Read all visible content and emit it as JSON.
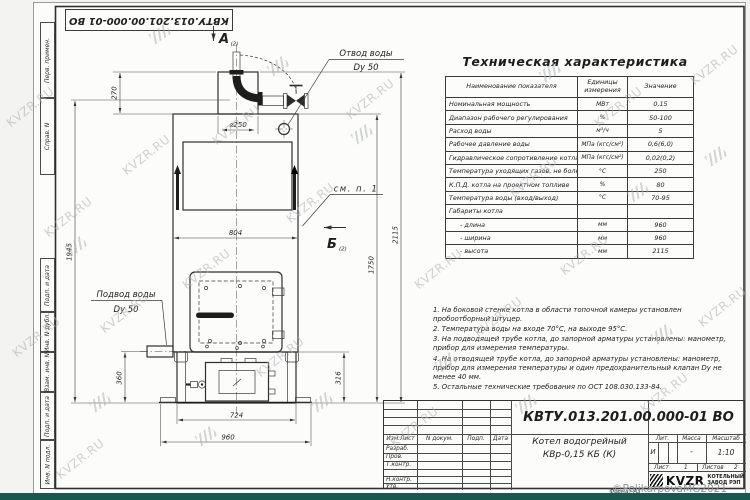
{
  "doc_number": "КВТУ.013.201.00.000-01 ВО",
  "wm": {
    "site": "KVZR.RU",
    "copyright": "©PolikarpovaMG2021"
  },
  "margin": {
    "items": [
      "Перв. примен.",
      "Справ. N",
      "Подп. и дата",
      "Инв. N дубл.",
      "Взам. инв. N",
      "Подп. и дата",
      "Инв. N подл."
    ]
  },
  "drawing": {
    "view_a": "А",
    "view_b": "Б",
    "view_ref": "(2)",
    "see_note": "см. п. 1",
    "outlet": {
      "line1": "Отвод воды",
      "line2": "Dy 50"
    },
    "inlet": {
      "line1": "Подвод воды",
      "line2": "Dy 50"
    },
    "dims": {
      "d270": "270",
      "d250": "⌀250",
      "d804": "804",
      "d1945": "1945",
      "d2115": "2115",
      "d1750": "1750",
      "d360": "360",
      "d316": "316",
      "d724": "724",
      "d960": "960"
    }
  },
  "tech": {
    "title": "Техническая характеристика",
    "headers": [
      "Наименование показателя",
      "Единицы измерения",
      "Значение"
    ],
    "rows": [
      {
        "name": "Номинальная мощность",
        "unit": "МВт",
        "value": "0,15"
      },
      {
        "name": "Диапазон рабочего регулирования",
        "unit": "%",
        "value": "50-100"
      },
      {
        "name": "Расход воды",
        "unit": "м³/ч",
        "value": "5"
      },
      {
        "name": "Рабочее давление воды",
        "unit": "МПа (кгс/см²)",
        "value": "0,6(6,0)"
      },
      {
        "name": "Гидравлическое сопротивление котла",
        "unit": "МПа (кгс/см²)",
        "value": "0,02(0,2)"
      },
      {
        "name": "Температура уходящих газов, не более",
        "unit": "°С",
        "value": "250"
      },
      {
        "name": "К.П.Д. котла на проектном топливе",
        "unit": "%",
        "value": "80"
      },
      {
        "name": "Температура воды (вход/выход)",
        "unit": "°С",
        "value": "70-95"
      },
      {
        "name": "Габариты котла",
        "unit": "",
        "value": ""
      },
      {
        "name": "- длина",
        "unit": "мм",
        "value": "960"
      },
      {
        "name": "- ширина",
        "unit": "мм",
        "value": "960"
      },
      {
        "name": "- высота",
        "unit": "мм",
        "value": "2115"
      }
    ]
  },
  "notes": [
    "1. На боковой стенке котла в области топочной камеры установлен пробоотборный штуцер.",
    "2. Температура воды на входе 70°С, на выходе 95°С.",
    "3. На подводящей трубе котла, до запорной арматуры установлены: манометр, прибор для измерения температуры.",
    "4. На отводящей трубе котла, до запорной арматуры установлены: манометр, прибор для измерения температуры и один предохранительный клапан Dy не менее 40 мм.",
    "5. Остальные технические требования по ОСТ 108.030.133-84."
  ],
  "tb": {
    "cols": {
      "izm": "Изм.Лист",
      "doc": "N докум.",
      "sign": "Подп.",
      "date": "Дата"
    },
    "rows": [
      "Разраб.",
      "Пров.",
      "Т.контр.",
      "Н.контр.",
      "Утв."
    ],
    "name1": "Котел водогрейный",
    "name2": "КВр-0,15 КБ (К)",
    "lit_h": "Лит.",
    "mass_h": "Масса",
    "scale_h": "Масштаб",
    "lit": "И",
    "mass": "-",
    "scale": "1:10",
    "sheet_l": "Лист",
    "sheet_v": "1",
    "sheets_l": "Листов",
    "sheets_v": "2",
    "logo": "KVZR",
    "logo_s1": "КОТЕЛЬНЫЙ",
    "logo_s2": "ЗАВОД РЭП",
    "format": "Формат А3"
  }
}
